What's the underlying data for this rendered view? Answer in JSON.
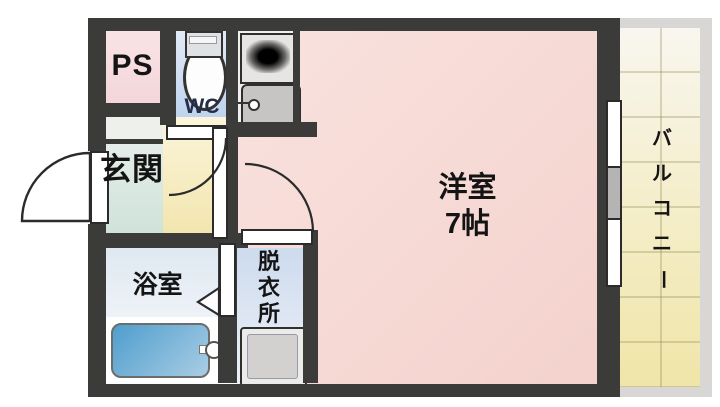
{
  "title": "apartment-floor-plan",
  "rooms": {
    "ps": {
      "label": "PS"
    },
    "wc": {
      "label": "WC"
    },
    "genkan": {
      "label": "玄関"
    },
    "main_room": {
      "name": "洋室",
      "size": "7帖"
    },
    "bathroom": {
      "label": "浴室"
    },
    "dressing_room": {
      "label": "脱衣所",
      "chars": [
        "脱",
        "衣",
        "所"
      ]
    },
    "balcony": {
      "label": "バルコニー",
      "chars": [
        "バ",
        "ル",
        "コ",
        "ニ",
        "ー"
      ]
    }
  },
  "palette": {
    "wall": "#3b3b39",
    "main_room": "#f6d8d4",
    "ps_room": "#f7dee1",
    "wc_room": "#c9d9f0",
    "genkan": "#d6e6de",
    "hallway": "#f6ecc0",
    "bathroom": "#e8eef5",
    "dressing_room": "#d3dff0",
    "balcony": "#f1e8b0",
    "balcony_frame": "#d8d7d5",
    "bathtub": "#5fa3cd",
    "fixture_grey": "#c6c5c3",
    "wc_text": "#232d46"
  }
}
